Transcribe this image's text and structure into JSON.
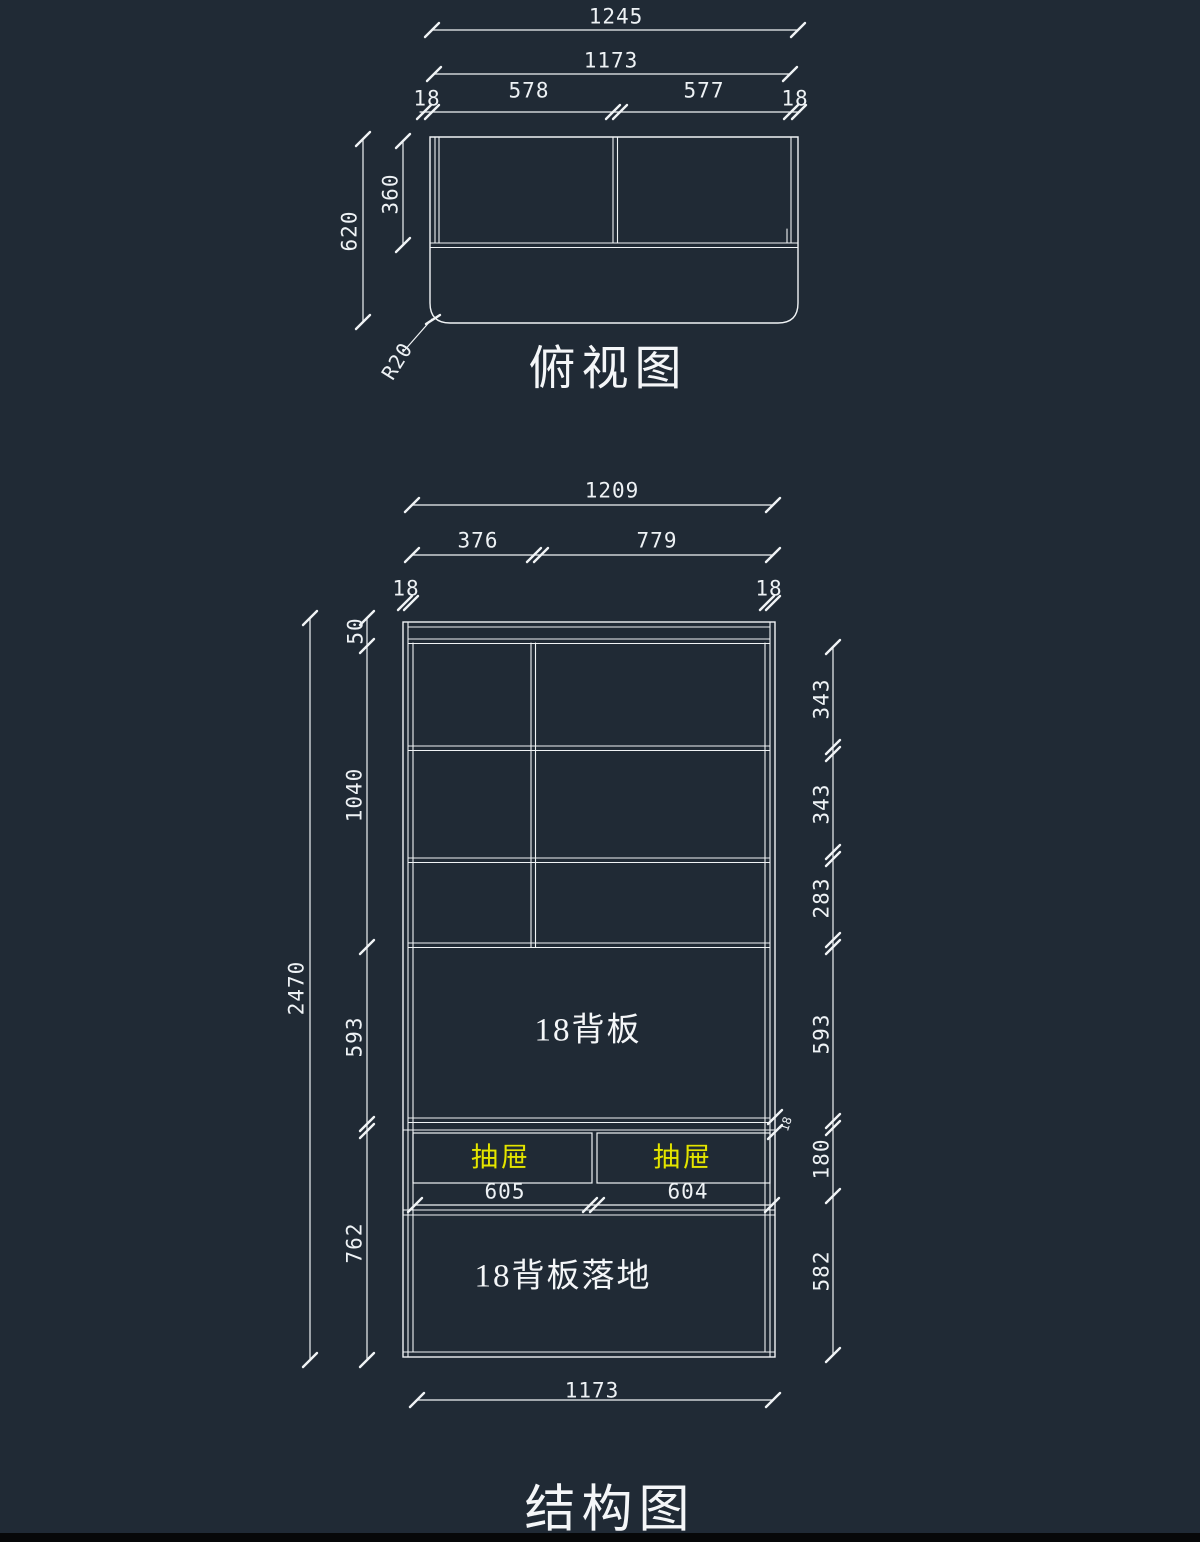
{
  "colors": {
    "background": "#202a35",
    "line": "#f0f3f5",
    "text": "#eef2f5",
    "drawer_text": "#e4e400"
  },
  "top_view": {
    "title": "俯视图",
    "dims": {
      "total_width": "1245",
      "inner_width": "1173",
      "side_left": "18",
      "cell_left": "578",
      "cell_right": "577",
      "side_right": "18",
      "depth_total": "620",
      "depth_back": "360",
      "corner_radius": "R20"
    }
  },
  "structure": {
    "title": "结构图",
    "top_dims": {
      "total_width": "1209",
      "col_left": "376",
      "col_right": "779",
      "side_left": "18",
      "side_right": "18"
    },
    "left_dims": {
      "total_height": "2470",
      "top_strip": "50",
      "grid": "1040",
      "back_panel": "593",
      "base": "762"
    },
    "right_dims": {
      "row1": "343",
      "row2": "343",
      "row3": "283",
      "back_panel": "593",
      "rib": "18",
      "drawer": "180",
      "base": "582"
    },
    "labels": {
      "back_panel": "18背板",
      "drawer_left": "抽屉",
      "drawer_right": "抽屉",
      "drawer_width_left": "605",
      "drawer_width_right": "604",
      "base_panel": "18背板落地",
      "bottom_width": "1173"
    }
  }
}
